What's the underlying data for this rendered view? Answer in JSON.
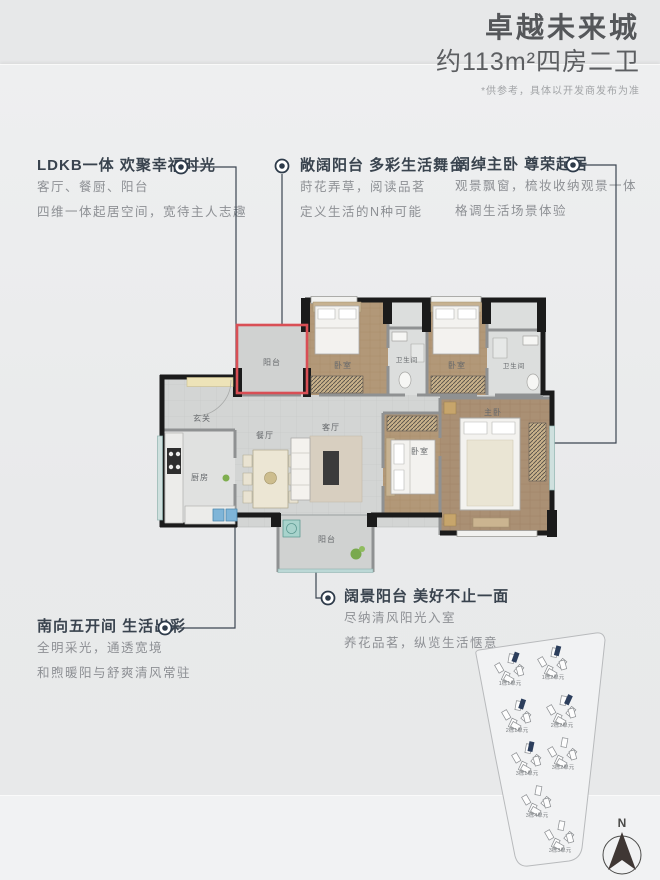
{
  "header": {
    "title": "卓越未来城",
    "subtitle": "约113m²四房二卫",
    "disclaimer": "*供参考，具体以开发商发布为准"
  },
  "callouts": [
    {
      "title": "LDKB一体 欢聚幸福时光",
      "line1": "客厅、餐厨、阳台",
      "line2": "四维一体起居空间，宽待主人志趣"
    },
    {
      "title": "敞阔阳台 多彩生活舞台",
      "line1": "莳花弄草，阅读品茗",
      "line2": "定义生活的N种可能"
    },
    {
      "title": "阔绰主卧 尊荣起居",
      "line1": "观景飘窗，梳妆收纳观景一体",
      "line2": "格调生活场景体验"
    },
    {
      "title": "南向五开间 生活出彩",
      "line1": "全明采光，通透宽境",
      "line2": "和煦暖阳与舒爽清风常驻"
    },
    {
      "title": "阔景阳台 美好不止一面",
      "line1": "尽纳清风阳光入室",
      "line2": "养花品茗，纵览生活惬意"
    }
  ],
  "floorplan": {
    "rooms": [
      {
        "label": "阳台"
      },
      {
        "label": "卧室"
      },
      {
        "label": "卫生间"
      },
      {
        "label": "卧室"
      },
      {
        "label": "卫生间"
      },
      {
        "label": "玄关"
      },
      {
        "label": "厨房"
      },
      {
        "label": "餐厅"
      },
      {
        "label": "客厅"
      },
      {
        "label": "卧室"
      },
      {
        "label": "主卧"
      },
      {
        "label": "阳台"
      }
    ]
  },
  "siteplan": {
    "units": [
      {
        "label": "1栋1单元"
      },
      {
        "label": "1栋2单元"
      },
      {
        "label": "2栋1单元"
      },
      {
        "label": "2栋2单元"
      },
      {
        "label": "3栋1单元"
      },
      {
        "label": "3栋2单元"
      },
      {
        "label": "3栋4单元"
      },
      {
        "label": "3栋3单元"
      }
    ],
    "north_label": "N"
  },
  "colors": {
    "accent_red": "#d94f55",
    "heading_text": "#39434e",
    "body_text": "#8d9094",
    "wall_black": "#1b1b1b",
    "wood_floor": "#b29878",
    "site_highlight": "#2c3e5c"
  }
}
